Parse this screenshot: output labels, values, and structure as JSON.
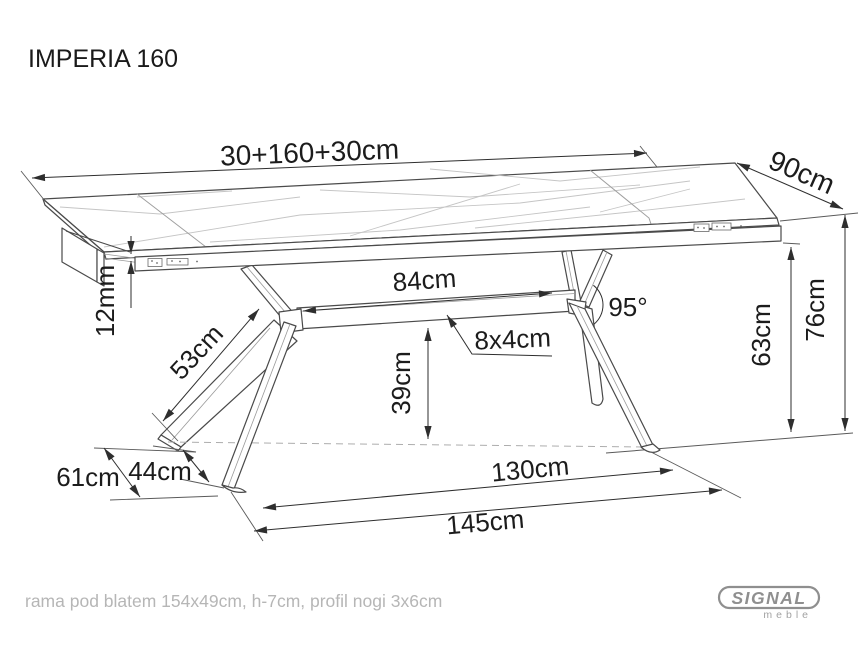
{
  "title": "IMPERIA 160",
  "footer_note": "rama pod blatem 154x49cm, h-7cm, profil nogi 3x6cm",
  "logo": {
    "brand": "SIGNAL",
    "sub": "meble"
  },
  "colors": {
    "line": "#4a4a4a",
    "dimension": "#2e2e2e",
    "muted_note": "#b6b6b6",
    "logo_gray": "#8f8f8f",
    "background": "#ffffff"
  },
  "dims": {
    "top_length": "30+160+30cm",
    "top_depth": "90cm",
    "top_thickness": "12mm",
    "leg_arm_length": "53cm",
    "crossbar_length": "84cm",
    "crossbar_profile": "8x4cm",
    "leg_angle": "95°",
    "crossbar_height": "39cm",
    "frame_clearance": "63cm",
    "table_height": "76cm",
    "feet_depth_outer": "61cm",
    "feet_depth_inner": "44cm",
    "feet_span_inner": "130cm",
    "feet_span_outer": "145cm"
  }
}
